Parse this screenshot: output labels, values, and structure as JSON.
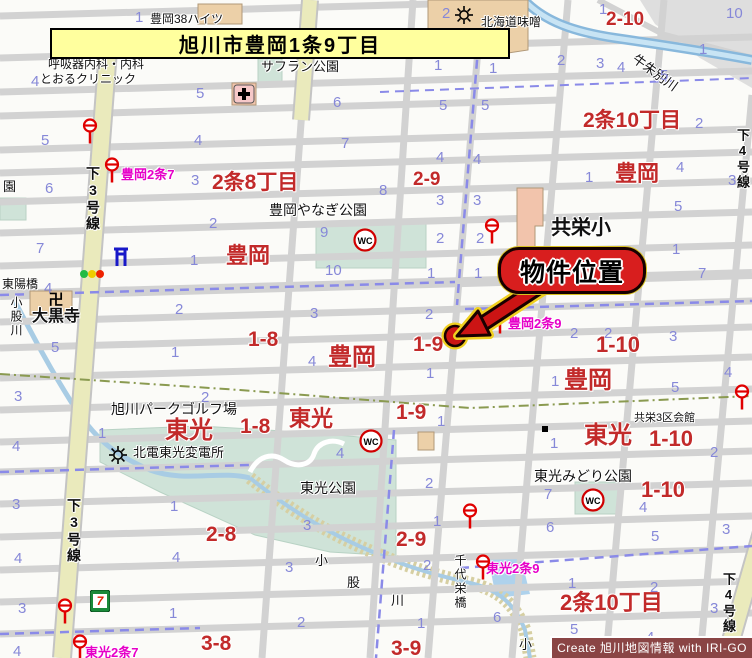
{
  "title": "旭川市豊岡1条9丁目",
  "callout_label": "物件位置",
  "attribution": "Create 旭川地図情報 with IRI-GO",
  "colors": {
    "area_label_red": "#c22a2a",
    "block_number_blue": "#8688d8",
    "busstop_label_magenta": "#e600c8",
    "main_road_yellow": "#eaeabc",
    "park_green": "#cfe3d8",
    "water_blue": "#a8cce4",
    "callout_red": "#d81e1e",
    "title_bg_yellow": "#ffff9e"
  },
  "map": {
    "labels": [
      {
        "t": "豊岡38ハイツ",
        "x": 150,
        "y": 13,
        "c": "k"
      },
      {
        "t": "北海道味噌",
        "x": 481,
        "y": 16,
        "c": "k"
      },
      {
        "t": "呼吸器内科・内科",
        "x": 48,
        "y": 58,
        "c": "k"
      },
      {
        "t": "とおるクリニック",
        "x": 40,
        "y": 73,
        "c": "k"
      },
      {
        "t": "サフラン公園",
        "x": 261,
        "y": 60,
        "c": "k",
        "s": 13
      },
      {
        "t": "豊岡やなぎ公園",
        "x": 269,
        "y": 203,
        "c": "k",
        "s": 14
      },
      {
        "t": "共栄小",
        "x": 551,
        "y": 218,
        "c": "k",
        "s": 20,
        "b": 1
      },
      {
        "t": "東陽橋",
        "x": 2,
        "y": 278,
        "c": "k"
      },
      {
        "t": "大黒寺",
        "x": 32,
        "y": 309,
        "c": "k",
        "s": 16,
        "b": 1
      },
      {
        "t": "小股川",
        "x": 10,
        "y": 296,
        "c": "k",
        "v": 1,
        "s": 12
      },
      {
        "t": "旭川パークゴルフ場",
        "x": 111,
        "y": 402,
        "c": "k",
        "s": 14
      },
      {
        "t": "北電東光変電所",
        "x": 133,
        "y": 446,
        "c": "k",
        "s": 13
      },
      {
        "t": "東光公園",
        "x": 300,
        "y": 481,
        "c": "k",
        "s": 14
      },
      {
        "t": "東光みどり公園",
        "x": 534,
        "y": 469,
        "c": "k",
        "s": 14
      },
      {
        "t": "共栄3区会館",
        "x": 634,
        "y": 413,
        "c": "k",
        "s": 11
      },
      {
        "t": "千代栄橋",
        "x": 454,
        "y": 554,
        "c": "k",
        "v": 1,
        "s": 12
      },
      {
        "t": "小",
        "x": 315,
        "y": 554,
        "c": "k",
        "s": 13
      },
      {
        "t": "股",
        "x": 347,
        "y": 576,
        "c": "k",
        "s": 13
      },
      {
        "t": "川",
        "x": 391,
        "y": 594,
        "c": "k",
        "s": 13
      },
      {
        "t": "小",
        "x": 519,
        "y": 638,
        "c": "k",
        "s": 13
      },
      {
        "t": "下3号線",
        "x": 86,
        "y": 166,
        "c": "k",
        "v": 1,
        "s": 14,
        "b": 1
      },
      {
        "t": "下3号線",
        "x": 67,
        "y": 498,
        "c": "k",
        "v": 1,
        "s": 14,
        "b": 1
      },
      {
        "t": "下4号線",
        "x": 722,
        "y": 572,
        "c": "k",
        "v": 1,
        "s": 13,
        "b": 1
      },
      {
        "t": "下4号線",
        "x": 736,
        "y": 128,
        "c": "k",
        "v": 1,
        "s": 13,
        "b": 1
      },
      {
        "t": "牛朱別川",
        "x": 638,
        "y": 52,
        "c": "k",
        "rot": 36,
        "s": 13
      },
      {
        "t": "園",
        "x": 3,
        "y": 180,
        "c": "k",
        "s": 13
      },
      {
        "t": "2条8丁目",
        "x": 212,
        "y": 172,
        "c": "r",
        "s": 21
      },
      {
        "t": "2-9",
        "x": 413,
        "y": 170,
        "c": "r",
        "s": 19
      },
      {
        "t": "2条10丁目",
        "x": 583,
        "y": 110,
        "c": "r",
        "s": 21
      },
      {
        "t": "豊岡",
        "x": 615,
        "y": 163,
        "c": "r",
        "s": 22
      },
      {
        "t": "2-10",
        "x": 606,
        "y": 10,
        "c": "r",
        "s": 19
      },
      {
        "t": "豊岡",
        "x": 226,
        "y": 245,
        "c": "r",
        "s": 22
      },
      {
        "t": "豊岡",
        "x": 328,
        "y": 346,
        "c": "r",
        "s": 24
      },
      {
        "t": "1-8",
        "x": 248,
        "y": 329,
        "c": "r",
        "s": 21
      },
      {
        "t": "1-9",
        "x": 413,
        "y": 334,
        "c": "r",
        "s": 21
      },
      {
        "t": "1-9",
        "x": 396,
        "y": 402,
        "c": "r",
        "s": 21
      },
      {
        "t": "1-8",
        "x": 240,
        "y": 416,
        "c": "r",
        "s": 21
      },
      {
        "t": "東光",
        "x": 165,
        "y": 419,
        "c": "r",
        "s": 24
      },
      {
        "t": "東光",
        "x": 289,
        "y": 408,
        "c": "r",
        "s": 22
      },
      {
        "t": "豊岡",
        "x": 564,
        "y": 369,
        "c": "r",
        "s": 24
      },
      {
        "t": "1-10",
        "x": 596,
        "y": 334,
        "c": "r",
        "s": 22
      },
      {
        "t": "東光",
        "x": 584,
        "y": 424,
        "c": "r",
        "s": 24
      },
      {
        "t": "1-10",
        "x": 649,
        "y": 428,
        "c": "r",
        "s": 22
      },
      {
        "t": "1-10",
        "x": 641,
        "y": 479,
        "c": "r",
        "s": 22
      },
      {
        "t": "2-8",
        "x": 206,
        "y": 524,
        "c": "r",
        "s": 21
      },
      {
        "t": "2-9",
        "x": 396,
        "y": 529,
        "c": "r",
        "s": 21
      },
      {
        "t": "3-8",
        "x": 201,
        "y": 633,
        "c": "r",
        "s": 21
      },
      {
        "t": "3-9",
        "x": 391,
        "y": 638,
        "c": "r",
        "s": 21
      },
      {
        "t": "2条10丁目",
        "x": 560,
        "y": 592,
        "c": "r",
        "s": 22
      },
      {
        "t": "豊岡2条7",
        "x": 121,
        "y": 168,
        "c": "m"
      },
      {
        "t": "豊岡2条9",
        "x": 508,
        "y": 317,
        "c": "m"
      },
      {
        "t": "東光2条9",
        "x": 486,
        "y": 562,
        "c": "m"
      },
      {
        "t": "東光2条7",
        "x": 85,
        "y": 646,
        "c": "m"
      },
      {
        "t": "1",
        "x": 135,
        "y": 10,
        "c": "n"
      },
      {
        "t": "2",
        "x": 442,
        "y": 6,
        "c": "n"
      },
      {
        "t": "1",
        "x": 599,
        "y": 2,
        "c": "n"
      },
      {
        "t": "10",
        "x": 726,
        "y": 6,
        "c": "n"
      },
      {
        "t": "4",
        "x": 31,
        "y": 74,
        "c": "n"
      },
      {
        "t": "5",
        "x": 196,
        "y": 86,
        "c": "n"
      },
      {
        "t": "1",
        "x": 434,
        "y": 58,
        "c": "n"
      },
      {
        "t": "1",
        "x": 489,
        "y": 61,
        "c": "n"
      },
      {
        "t": "2",
        "x": 557,
        "y": 53,
        "c": "n"
      },
      {
        "t": "3",
        "x": 596,
        "y": 56,
        "c": "n"
      },
      {
        "t": "4",
        "x": 617,
        "y": 60,
        "c": "n"
      },
      {
        "t": "5",
        "x": 660,
        "y": 68,
        "c": "n"
      },
      {
        "t": "1",
        "x": 699,
        "y": 42,
        "c": "n"
      },
      {
        "t": "6",
        "x": 333,
        "y": 95,
        "c": "n"
      },
      {
        "t": "5",
        "x": 439,
        "y": 98,
        "c": "n"
      },
      {
        "t": "5",
        "x": 481,
        "y": 98,
        "c": "n"
      },
      {
        "t": "5",
        "x": 41,
        "y": 133,
        "c": "n"
      },
      {
        "t": "4",
        "x": 194,
        "y": 133,
        "c": "n"
      },
      {
        "t": "7",
        "x": 341,
        "y": 136,
        "c": "n"
      },
      {
        "t": "4",
        "x": 436,
        "y": 150,
        "c": "n"
      },
      {
        "t": "4",
        "x": 473,
        "y": 152,
        "c": "n"
      },
      {
        "t": "2",
        "x": 695,
        "y": 116,
        "c": "n"
      },
      {
        "t": "6",
        "x": 45,
        "y": 181,
        "c": "n"
      },
      {
        "t": "3",
        "x": 191,
        "y": 173,
        "c": "n"
      },
      {
        "t": "8",
        "x": 379,
        "y": 183,
        "c": "n"
      },
      {
        "t": "3",
        "x": 436,
        "y": 193,
        "c": "n"
      },
      {
        "t": "3",
        "x": 473,
        "y": 193,
        "c": "n"
      },
      {
        "t": "1",
        "x": 585,
        "y": 170,
        "c": "n"
      },
      {
        "t": "4",
        "x": 676,
        "y": 160,
        "c": "n"
      },
      {
        "t": "3",
        "x": 728,
        "y": 173,
        "c": "n"
      },
      {
        "t": "2",
        "x": 209,
        "y": 216,
        "c": "n"
      },
      {
        "t": "9",
        "x": 320,
        "y": 225,
        "c": "n"
      },
      {
        "t": "2",
        "x": 436,
        "y": 231,
        "c": "n"
      },
      {
        "t": "2",
        "x": 476,
        "y": 231,
        "c": "n"
      },
      {
        "t": "5",
        "x": 674,
        "y": 199,
        "c": "n"
      },
      {
        "t": "7",
        "x": 36,
        "y": 241,
        "c": "n"
      },
      {
        "t": "1",
        "x": 190,
        "y": 253,
        "c": "n"
      },
      {
        "t": "10",
        "x": 325,
        "y": 263,
        "c": "n"
      },
      {
        "t": "1",
        "x": 427,
        "y": 266,
        "c": "n"
      },
      {
        "t": "1",
        "x": 474,
        "y": 266,
        "c": "n"
      },
      {
        "t": "1",
        "x": 672,
        "y": 242,
        "c": "n"
      },
      {
        "t": "7",
        "x": 698,
        "y": 266,
        "c": "n"
      },
      {
        "t": "4",
        "x": 44,
        "y": 281,
        "c": "n"
      },
      {
        "t": "2",
        "x": 175,
        "y": 302,
        "c": "n"
      },
      {
        "t": "3",
        "x": 310,
        "y": 306,
        "c": "n"
      },
      {
        "t": "2",
        "x": 425,
        "y": 307,
        "c": "n"
      },
      {
        "t": "2",
        "x": 570,
        "y": 326,
        "c": "n"
      },
      {
        "t": "2",
        "x": 604,
        "y": 326,
        "c": "n"
      },
      {
        "t": "3",
        "x": 669,
        "y": 329,
        "c": "n"
      },
      {
        "t": "4",
        "x": 724,
        "y": 365,
        "c": "n"
      },
      {
        "t": "5",
        "x": 51,
        "y": 340,
        "c": "n"
      },
      {
        "t": "1",
        "x": 171,
        "y": 345,
        "c": "n"
      },
      {
        "t": "4",
        "x": 308,
        "y": 354,
        "c": "n"
      },
      {
        "t": "1",
        "x": 426,
        "y": 366,
        "c": "n"
      },
      {
        "t": "1",
        "x": 551,
        "y": 374,
        "c": "n"
      },
      {
        "t": "5",
        "x": 671,
        "y": 380,
        "c": "n"
      },
      {
        "t": "3",
        "x": 14,
        "y": 389,
        "c": "n"
      },
      {
        "t": "2",
        "x": 201,
        "y": 390,
        "c": "n"
      },
      {
        "t": "1",
        "x": 437,
        "y": 414,
        "c": "n"
      },
      {
        "t": "1",
        "x": 98,
        "y": 426,
        "c": "n"
      },
      {
        "t": "4",
        "x": 336,
        "y": 446,
        "c": "n"
      },
      {
        "t": "1",
        "x": 550,
        "y": 436,
        "c": "n"
      },
      {
        "t": "2",
        "x": 710,
        "y": 445,
        "c": "n"
      },
      {
        "t": "4",
        "x": 12,
        "y": 439,
        "c": "n"
      },
      {
        "t": "2",
        "x": 425,
        "y": 476,
        "c": "n"
      },
      {
        "t": "7",
        "x": 544,
        "y": 487,
        "c": "n"
      },
      {
        "t": "4",
        "x": 639,
        "y": 500,
        "c": "n"
      },
      {
        "t": "3",
        "x": 12,
        "y": 497,
        "c": "n"
      },
      {
        "t": "1",
        "x": 170,
        "y": 499,
        "c": "n"
      },
      {
        "t": "3",
        "x": 303,
        "y": 518,
        "c": "n"
      },
      {
        "t": "1",
        "x": 433,
        "y": 514,
        "c": "n"
      },
      {
        "t": "6",
        "x": 546,
        "y": 520,
        "c": "n"
      },
      {
        "t": "3",
        "x": 722,
        "y": 522,
        "c": "n"
      },
      {
        "t": "5",
        "x": 651,
        "y": 529,
        "c": "n"
      },
      {
        "t": "4",
        "x": 14,
        "y": 551,
        "c": "n"
      },
      {
        "t": "4",
        "x": 172,
        "y": 550,
        "c": "n"
      },
      {
        "t": "3",
        "x": 285,
        "y": 560,
        "c": "n"
      },
      {
        "t": "2",
        "x": 423,
        "y": 558,
        "c": "n"
      },
      {
        "t": "1",
        "x": 568,
        "y": 576,
        "c": "n"
      },
      {
        "t": "2",
        "x": 650,
        "y": 580,
        "c": "n"
      },
      {
        "t": "3",
        "x": 18,
        "y": 601,
        "c": "n"
      },
      {
        "t": "1",
        "x": 169,
        "y": 606,
        "c": "n"
      },
      {
        "t": "6",
        "x": 493,
        "y": 610,
        "c": "n"
      },
      {
        "t": "3",
        "x": 710,
        "y": 601,
        "c": "n"
      },
      {
        "t": "4",
        "x": 13,
        "y": 644,
        "c": "n"
      },
      {
        "t": "2",
        "x": 297,
        "y": 615,
        "c": "n"
      },
      {
        "t": "1",
        "x": 417,
        "y": 616,
        "c": "n"
      },
      {
        "t": "5",
        "x": 570,
        "y": 622,
        "c": "n"
      },
      {
        "t": "4",
        "x": 646,
        "y": 630,
        "c": "n"
      }
    ],
    "icons": [
      {
        "t": "bus",
        "x": 90,
        "y": 131
      },
      {
        "t": "bus",
        "x": 112,
        "y": 170
      },
      {
        "t": "bus",
        "x": 492,
        "y": 231
      },
      {
        "t": "bus",
        "x": 500,
        "y": 321
      },
      {
        "t": "bus",
        "x": 470,
        "y": 516
      },
      {
        "t": "bus",
        "x": 483,
        "y": 567
      },
      {
        "t": "bus",
        "x": 742,
        "y": 397
      },
      {
        "t": "bus",
        "x": 65,
        "y": 611
      },
      {
        "t": "bus",
        "x": 80,
        "y": 647
      },
      {
        "t": "wc",
        "x": 365,
        "y": 240
      },
      {
        "t": "wc",
        "x": 371,
        "y": 441
      },
      {
        "t": "wc",
        "x": 593,
        "y": 500
      },
      {
        "t": "traffic",
        "x": 92,
        "y": 274
      },
      {
        "t": "temple",
        "x": 56,
        "y": 300
      },
      {
        "t": "gate",
        "x": 121,
        "y": 256
      },
      {
        "t": "gear",
        "x": 464,
        "y": 15
      },
      {
        "t": "gear",
        "x": 118,
        "y": 455
      },
      {
        "t": "hospital",
        "x": 244,
        "y": 94
      },
      {
        "t": "seven",
        "x": 100,
        "y": 601
      },
      {
        "t": "dot",
        "x": 545,
        "y": 429
      },
      {
        "t": "target",
        "x": 455,
        "y": 336
      }
    ]
  }
}
